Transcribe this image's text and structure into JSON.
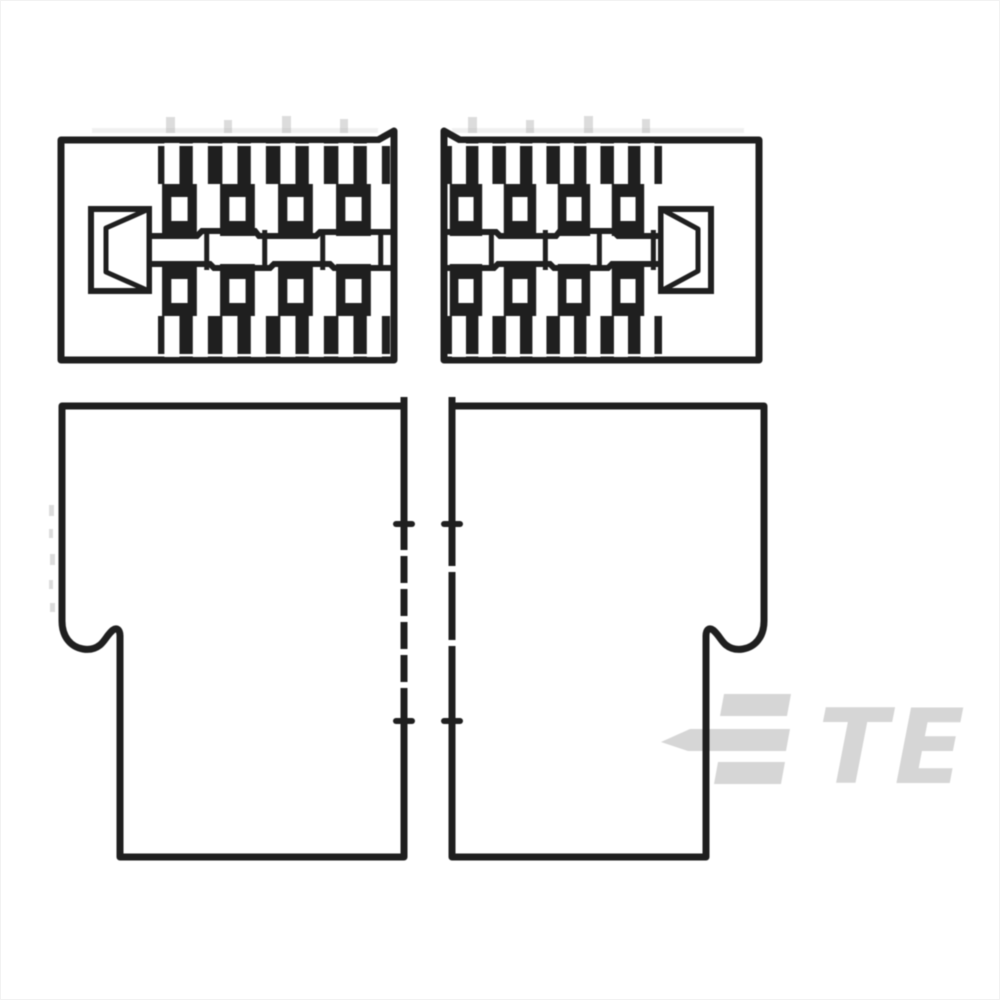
{
  "image": {
    "title": "Connector housing technical line drawing",
    "description": "Black-and-white sectional drawing of a two-part electrical connector housing: upper pair shows internal cross-sections with contact cavities and center sockets, lower pair shows outer side profiles with latch steps; halves are separated at a vertical center split.",
    "style": "monochrome engineering drawing, blurred scan"
  },
  "views": {
    "top_left": "left half cross-section, socket opening facing left, contact cavities along a center shaft",
    "top_right": "right half cross-section, socket opening facing right, contact cavities along a center shaft",
    "bottom_left": "left half outer profile, latch step notch on lower-left side, split-line ticks on right edge",
    "bottom_right": "right half outer profile, latch step notch on lower-right side, split-line ticks on left edge"
  },
  "sections": {
    "left": {
      "cavity_columns": 4
    },
    "right": {
      "cavity_columns": 4
    }
  },
  "split_line": {
    "tick_rows": 2
  },
  "watermark": {
    "text": "TE",
    "name": "TE Connectivity logo watermark"
  },
  "colors": {
    "bg": "#ffffff",
    "line": "#1f1f1f",
    "watermark": "#d6d6d6",
    "artifact": "#b9b9b9"
  }
}
